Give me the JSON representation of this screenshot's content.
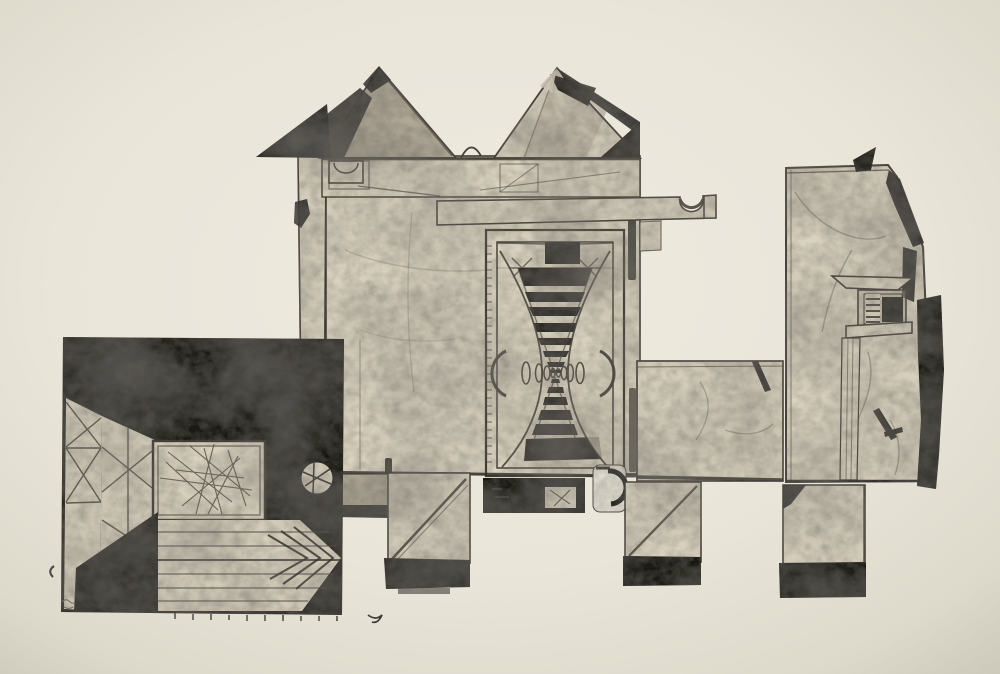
{
  "artwork": {
    "title": "Untitled — unfolded architectural structure, ink print on cream paper",
    "description": "Photograph of a black ink collagraph-style print on cream paper. A flattened, box-like building with two gabled roofs sits at center; a tall doorway contains a corridor of converging black ladder stripes with a row of shrinking ovals at its vanishing line. A long beam with a hooked notch extends to the right toward a tall torn-edged panel holding a small perspective window niche. At lower left an attached black square panel shows a room in perspective with cross-braced walls, a scratched back wall, a spoked porthole and a chevron-marked floor. Unfolded tabs and legs with solid inked feet hang from the bottom edge.",
    "palette": {
      "paper": "#eae6da",
      "paper_edge": "#d2cec0",
      "tone_light": "#d9d2bf",
      "tone_mid": "#b3ab99",
      "tone_dark": "#6f6759",
      "ink": "#1b1a16",
      "line": "#3c382f",
      "scratch": "#4a463e"
    },
    "elements": [
      {
        "name": "left-room-panel",
        "note": "black square panel with perspective room, porthole and chevron floor"
      },
      {
        "name": "central-building",
        "note": "main facade with twin gables and eaves band"
      },
      {
        "name": "left-gable",
        "note": "gable with black wing flap extending left"
      },
      {
        "name": "right-gable",
        "note": "gable with torn black ink patches on right slope"
      },
      {
        "name": "cantilever-beam",
        "note": "long beam ending in a hooked semicircular notch"
      },
      {
        "name": "doorway-corridor",
        "note": "tall door with hourglass of converging black stripes and oval vanishing dots"
      },
      {
        "name": "bridge-section",
        "note": "horizontal slab linking facade to right panel"
      },
      {
        "name": "right-panel",
        "note": "tall sheet with torn inked upper-right edge and window niche"
      },
      {
        "name": "window-niche",
        "note": "small perspective window with ladder stripes and dark opening"
      },
      {
        "name": "tabs-and-legs",
        "note": "unfolded flaps with diagonal fold lines and solid black feet"
      },
      {
        "name": "slot-band",
        "note": "black band under door with light slot window"
      },
      {
        "name": "hook-mark",
        "note": "white tab with curved black hook stroke"
      },
      {
        "name": "porthole",
        "note": "white circle with spokes inside black field"
      },
      {
        "name": "pencil-scribble",
        "note": "illegible small pencil mark at lower-left margin"
      }
    ]
  }
}
